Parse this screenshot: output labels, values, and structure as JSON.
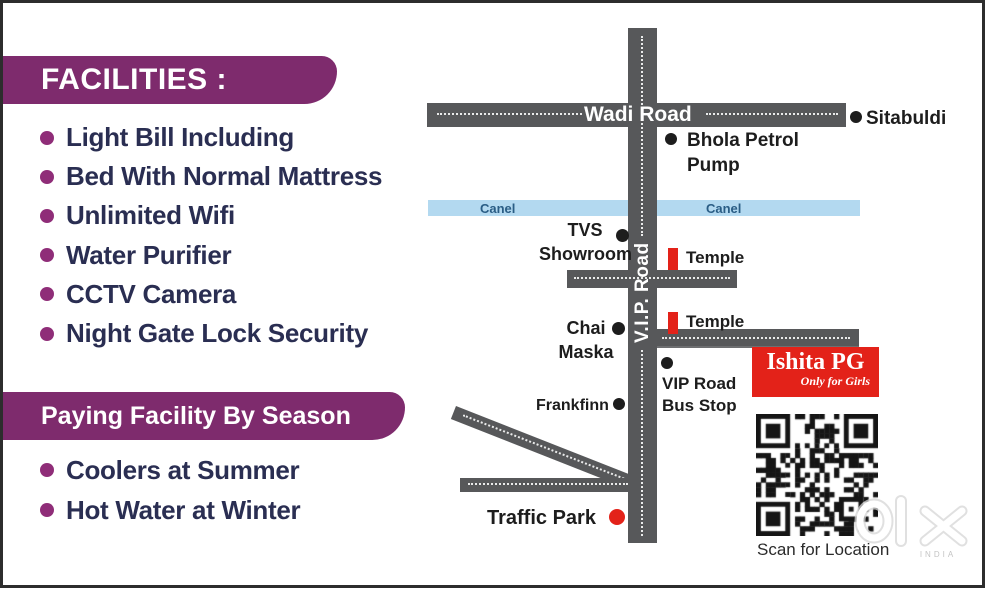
{
  "facilities": {
    "header": "FACILITIES :",
    "items": [
      "Light Bill Including",
      "Bed With Normal Mattress",
      "Unlimited Wifi",
      "Water Purifier",
      "CCTV Camera",
      "Night Gate Lock Security"
    ]
  },
  "season": {
    "header": "Paying Facility By Season",
    "items": [
      "Coolers at Summer",
      "Hot Water at Winter"
    ]
  },
  "map": {
    "roads": {
      "wadi": "Wadi Road",
      "vip": "V.I.P. Road"
    },
    "canal_label": "Canel",
    "landmarks": {
      "sitabuldi": "Sitabuldi",
      "bhola": "Bhola Petrol Pump",
      "tvs": "TVS Showroom",
      "temple": "Temple",
      "chai": "Chai Maska",
      "bus_stop": "VIP Road Bus Stop",
      "frankfinn": "Frankfinn",
      "traffic_park": "Traffic Park"
    },
    "ishita": {
      "title": "Ishita PG",
      "subtitle": "Only for Girls"
    },
    "qr_caption": "Scan for Location"
  },
  "watermark": {
    "brand": "olx",
    "region": "INDIA"
  },
  "colors": {
    "banner_purple": "#7e2b6d",
    "bullet_magenta": "#8f2d78",
    "list_text_navy": "#2a2e52",
    "road_gray": "#57585a",
    "canal_blue": "#b3d9f0",
    "accent_red": "#e32219"
  }
}
